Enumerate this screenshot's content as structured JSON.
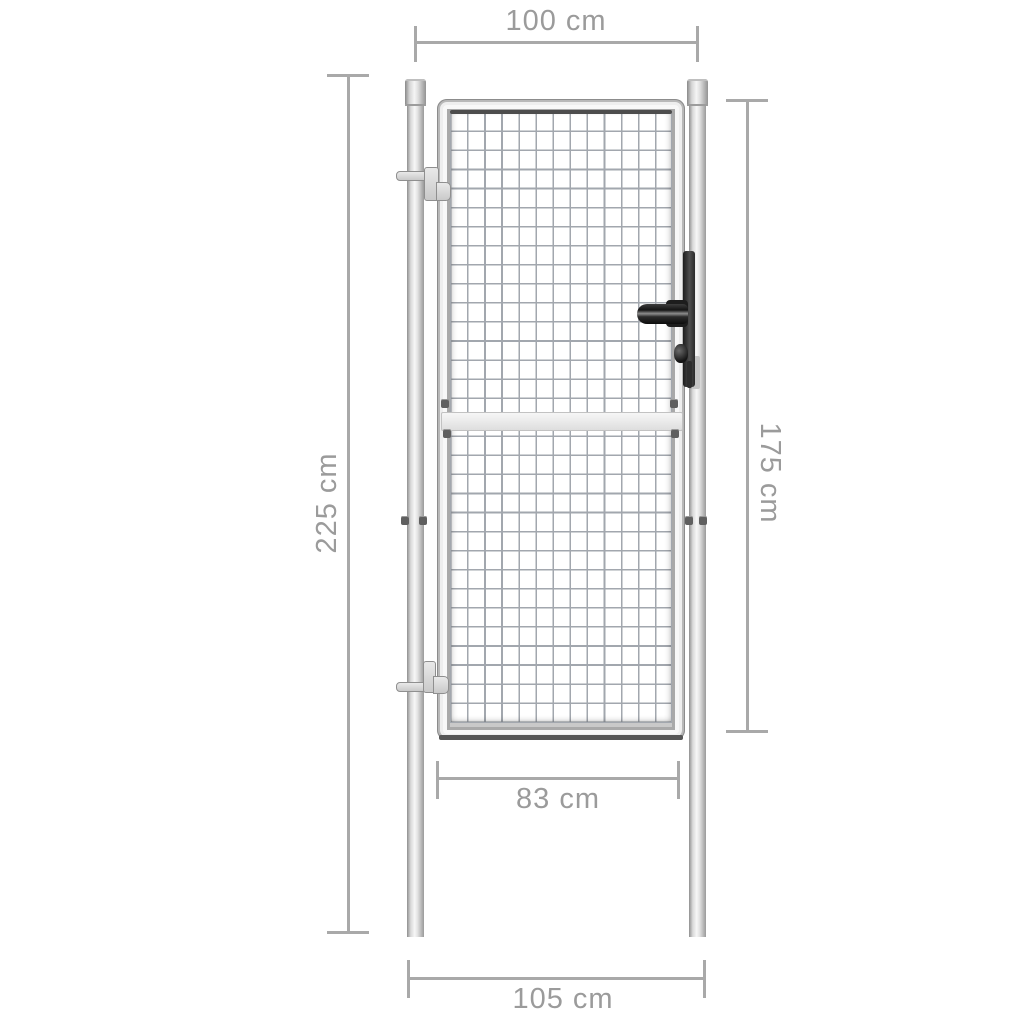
{
  "diagram": {
    "subject": "garden-gate-with-posts-dimension-diagram",
    "dimensions": {
      "top_width": {
        "label": "100 cm",
        "value_cm": 100,
        "orientation": "horizontal"
      },
      "post_height": {
        "label": "225 cm",
        "value_cm": 225,
        "orientation": "vertical"
      },
      "gate_height": {
        "label": "175 cm",
        "value_cm": 175,
        "orientation": "vertical"
      },
      "inner_width": {
        "label": "83 cm",
        "value_cm": 83,
        "orientation": "horizontal"
      },
      "outer_width": {
        "label": "105 cm",
        "value_cm": 105,
        "orientation": "horizontal"
      }
    },
    "colors": {
      "background": "#ffffff",
      "dimension_line": "#a9a9a9",
      "dimension_text": "#9b9b9b",
      "metal_light": "#f7f7f7",
      "metal_dark": "#8f8f8f",
      "mesh_wire": "#a2a7ae",
      "hardware_dark": "#1d1d1d"
    }
  }
}
